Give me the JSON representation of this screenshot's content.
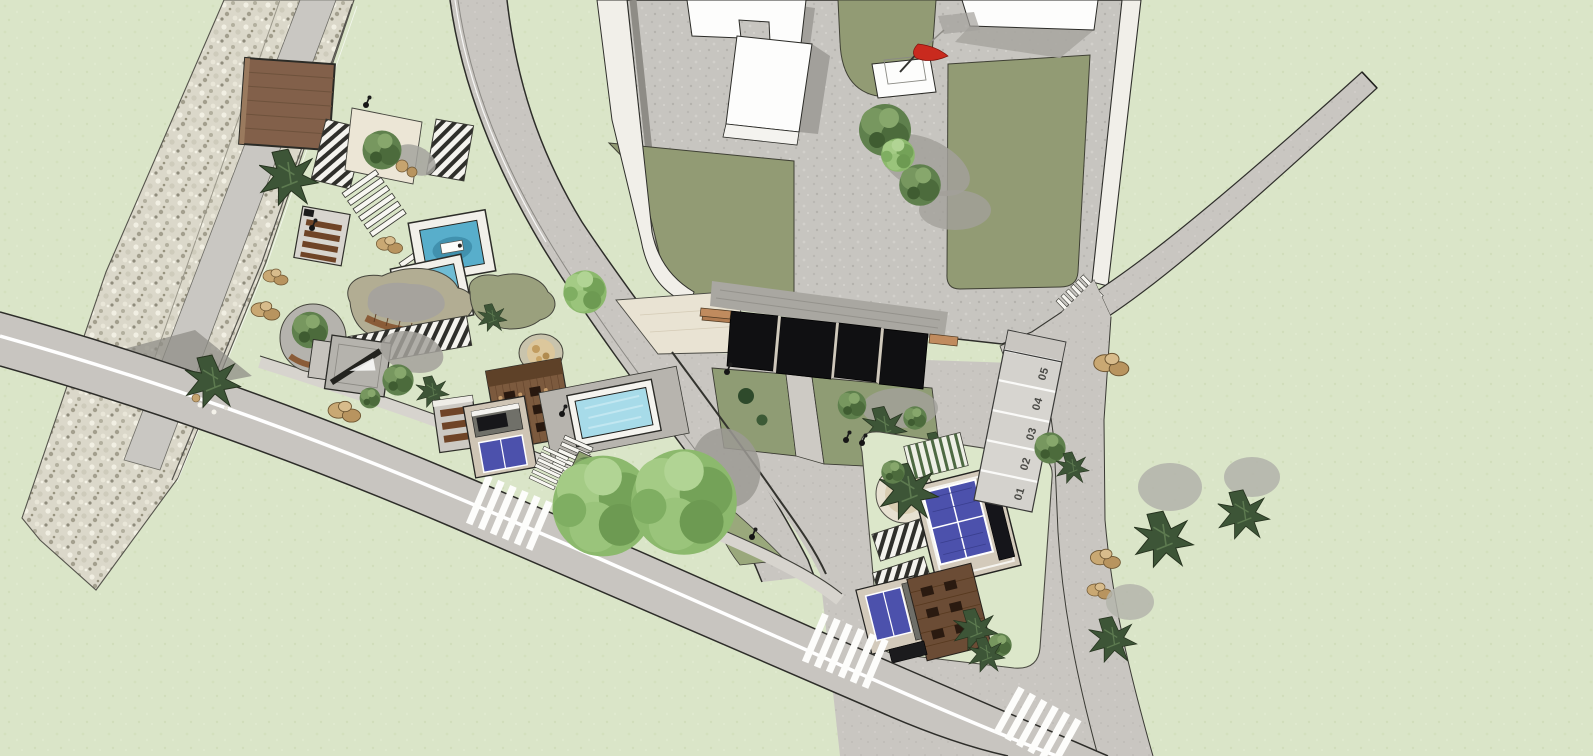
{
  "scene": {
    "title": "Site plan 3D render - top view",
    "parking": {
      "spaces": [
        {
          "label": "01"
        },
        {
          "label": "02"
        },
        {
          "label": "03"
        },
        {
          "label": "04"
        },
        {
          "label": "05"
        }
      ]
    },
    "palette": {
      "grass": "#dae5c8",
      "road": "#c8c5c0",
      "roadLine": "#ffffff",
      "plaza": "#c7c5c0",
      "sidewalk": "#f1efe9",
      "lawnOlive": "#929b74",
      "poolTeal": "#58aecb",
      "poolLight": "#a7dbe9",
      "solarBlue": "#4c51ac",
      "canopyBlack": "#101012",
      "woodDeck": "#82604a",
      "woodFurniture": "#6f4427",
      "gravel": "#dbd8ca",
      "rock": "#c6a46f",
      "treeGreen": "#5f804d",
      "treeDark": "#3d5537",
      "treeLight": "#8cb96d",
      "shadowGray": "#a19f99",
      "buildingWhite": "#fdfdfc",
      "flagRed": "#c92a1e",
      "creamPaving": "#e9e3d3",
      "label": "#4a4a46"
    }
  }
}
